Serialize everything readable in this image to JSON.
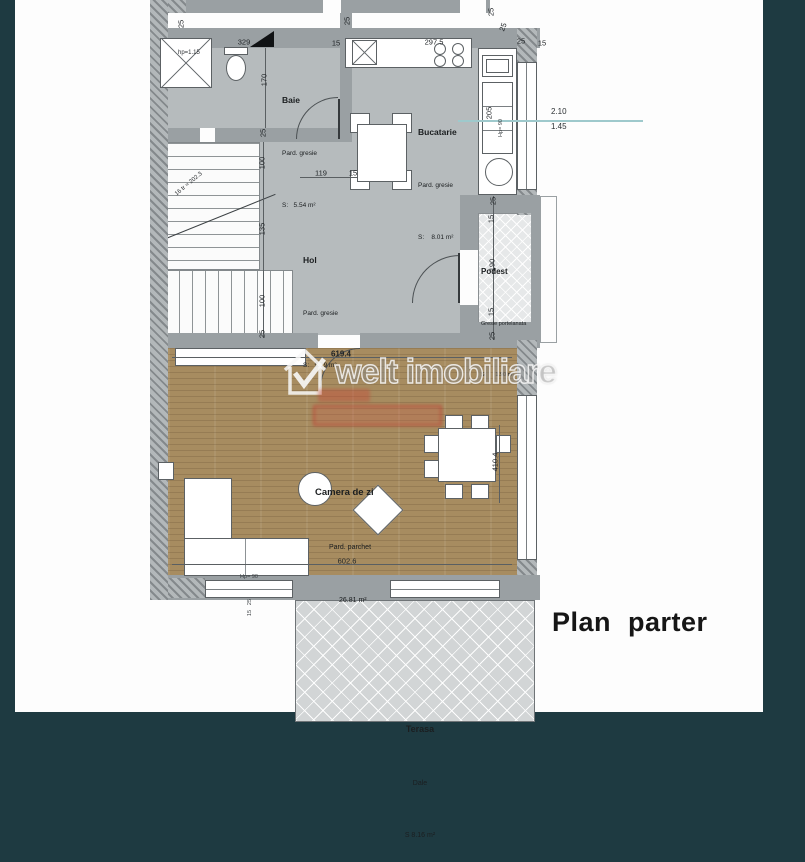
{
  "title": {
    "text": "Plan parter"
  },
  "watermark": {
    "text": "welt imobiliare"
  },
  "colors": {
    "frame_teal": "#1e3a41",
    "wall_gray": "#9aa0a3",
    "floor_gresie": "#b6bbbd",
    "parquet_brown": "#a78c60",
    "stamp_red": "#c64838",
    "annotation_teal": "#9ec9cc"
  },
  "rooms": {
    "baie": {
      "name": "Baie",
      "floor": "Pard. gresie",
      "area": "S:   5.54 m²"
    },
    "bucatarie": {
      "name": "Bucatarie",
      "floor": "Pard. gresie",
      "area": "S:    8.01 m²"
    },
    "hol": {
      "name": "Hol",
      "floor": "Pard. gresie",
      "area": "S:   9.79 m²"
    },
    "podest": {
      "name": "Podest",
      "floor": "Gresie portelanata",
      "area": "S:      1.90 m²"
    },
    "camera_de_zi": {
      "name": "Camera de zi",
      "floor": "Pard. parchet",
      "area": "26.81 m²"
    },
    "terasa": {
      "name": "Terasa",
      "floor": "Dale",
      "area": "S 8.16 m²"
    }
  },
  "annotations": {
    "height_upper": "2.10",
    "height_lower": "1.45",
    "shower_height": "hp=1.15",
    "stair_note": "16 tr ≈ 202.3"
  },
  "dimensions": [
    {
      "text": "25",
      "x": 181,
      "y": 24,
      "rot": -90
    },
    {
      "text": "329",
      "x": 244,
      "y": 42,
      "rot": 0
    },
    {
      "text": "15",
      "x": 336,
      "y": 43,
      "rot": 0
    },
    {
      "text": "25",
      "x": 347,
      "y": 21,
      "rot": -90
    },
    {
      "text": "297.5",
      "x": 434,
      "y": 42,
      "rot": 0
    },
    {
      "text": "25",
      "x": 521,
      "y": 41,
      "rot": 0
    },
    {
      "text": "15",
      "x": 542,
      "y": 43,
      "rot": 0
    },
    {
      "text": "25",
      "x": 491,
      "y": 12,
      "rot": -90
    },
    {
      "text": "25",
      "x": 503,
      "y": 27,
      "rot": -70
    },
    {
      "text": "170",
      "x": 264,
      "y": 80,
      "rot": -90
    },
    {
      "text": "25",
      "x": 263,
      "y": 133,
      "rot": -90
    },
    {
      "text": "100",
      "x": 262,
      "y": 163,
      "rot": -90
    },
    {
      "text": "119",
      "x": 321,
      "y": 173,
      "rot": 0
    },
    {
      "text": "15",
      "x": 353,
      "y": 173,
      "rot": 0
    },
    {
      "text": "135",
      "x": 262,
      "y": 229,
      "rot": -90
    },
    {
      "text": "100",
      "x": 262,
      "y": 301,
      "rot": -90
    },
    {
      "text": "25",
      "x": 262,
      "y": 334,
      "rot": -90
    },
    {
      "text": "205",
      "x": 489,
      "y": 113,
      "rot": -90
    },
    {
      "text": "Hp= 90",
      "x": 501,
      "y": 128,
      "rot": -90,
      "cls": "sm"
    },
    {
      "text": "25",
      "x": 493,
      "y": 201,
      "rot": -90
    },
    {
      "text": "15",
      "x": 491,
      "y": 219,
      "rot": -90
    },
    {
      "text": "190",
      "x": 492,
      "y": 265,
      "rot": -90
    },
    {
      "text": "15",
      "x": 491,
      "y": 312,
      "rot": -90
    },
    {
      "text": "25",
      "x": 492,
      "y": 336,
      "rot": -90
    },
    {
      "text": "619.4",
      "x": 341,
      "y": 354,
      "rot": 0,
      "cls": "bold"
    },
    {
      "text": "410.4",
      "x": 495,
      "y": 462,
      "rot": -90
    },
    {
      "text": "602.6",
      "x": 347,
      "y": 561,
      "rot": 0
    },
    {
      "text": "Hp= 90",
      "x": 249,
      "y": 577,
      "rot": 0,
      "cls": "sm"
    },
    {
      "text": "25",
      "x": 250,
      "y": 602,
      "rot": -90,
      "cls": "sm"
    },
    {
      "text": "15",
      "x": 250,
      "y": 613,
      "rot": -90,
      "cls": "sm"
    }
  ]
}
